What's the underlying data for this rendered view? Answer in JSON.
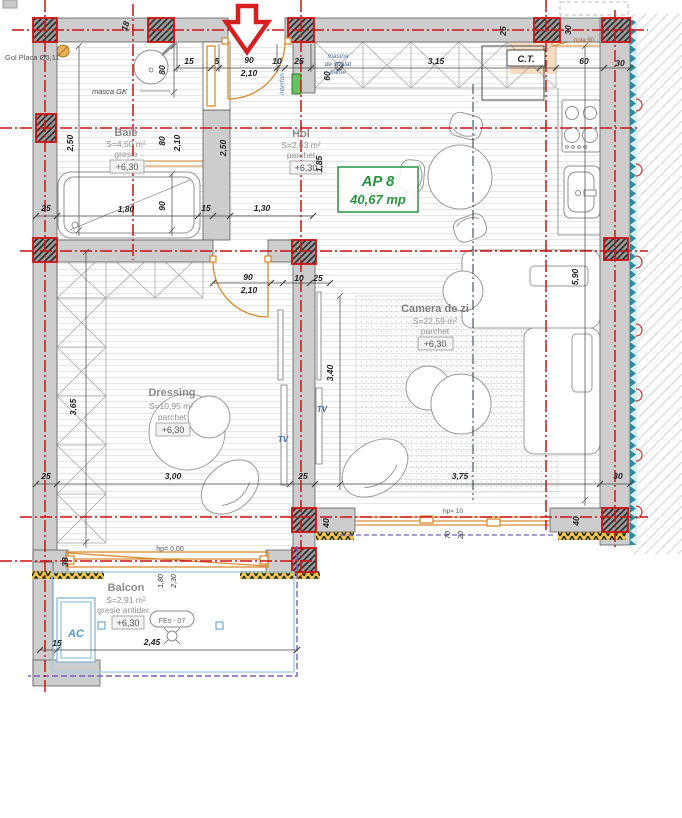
{
  "apartment": {
    "id": "AP 8",
    "area": "40,67 mp"
  },
  "rooms": {
    "baie": {
      "name": "Baie",
      "area": "S=4,50 m²",
      "finish": "gresie",
      "level": "+6,30"
    },
    "hol": {
      "name": "Hol",
      "area": "S=2,63 m²",
      "finish": "parchet",
      "level": "+6,30"
    },
    "camera_de_zi": {
      "name": "Camera de zi",
      "area": "S=22,59 m²",
      "finish": "parchet",
      "level": "+6,30"
    },
    "dressing": {
      "name": "Dressing",
      "area": "S=10,95 m²",
      "finish": "parchet",
      "level": "+6,30"
    },
    "balcon": {
      "name": "Balcon",
      "area": "S=2,91 m²",
      "finish": "gresie antider.",
      "level": "+6,30"
    }
  },
  "equipment": {
    "ct": "C.T.",
    "ac": "AC",
    "tv_left": "TV",
    "tv_right": "TV",
    "interfon": "interfon",
    "washing_machine": [
      "masina",
      "de spalat",
      "haine"
    ],
    "hood": "hota 90",
    "masca": "masca GK",
    "gol_placa": "Gol Placa Ø0,11",
    "window_code": "FEs - 07",
    "hp_balcony": "hp= 0,00",
    "hp_window": "hp= 10"
  },
  "dimensions": {
    "top_15": "15",
    "top_5": "5",
    "entry_door_width": "90",
    "entry_door_height": "2,10",
    "top_10": "10",
    "top_25": "25",
    "kitchen_wall": "3,15",
    "kitchen_60": "60",
    "kitchen_30": "30",
    "wall_25": "25",
    "hood_30": "30",
    "wall_18": "18",
    "washer_60": "60",
    "baie_height": "2,50",
    "sink_80": "80",
    "niche_80": "80",
    "niche_210": "2,10",
    "hol_height": "2,50",
    "hol_opening": "1,85",
    "tub_length": "1,80",
    "tub_width": "90",
    "left_25": "25",
    "wall_15": "15",
    "hol_width": "1,30",
    "dr_door_width": "90",
    "dr_door_height": "2,10",
    "dr_door_10": "10",
    "dr_door_25": "25",
    "living_340": "3,40",
    "living_590": "5,90",
    "living_375": "3,75",
    "right_30": "30",
    "col_40a": "40",
    "col_40b": "40",
    "dressing_365": "3,65",
    "dressing_300": "3,00",
    "bottom_25a": "25",
    "bottom_25b": "25",
    "balcony_38": "38",
    "balcony_15": "15",
    "balcony_245": "2,45",
    "balcony_window_180": "1,80",
    "balcony_window_230": "2,30",
    "sill_70": "70",
    "sill_20": "20"
  },
  "colors": {
    "axis_red": "#cc1111",
    "joinery_orange": "#d88a30",
    "apartment_green": "#27963f",
    "text_blue": "#3f6fae",
    "railing_purple": "#7a5fc0",
    "insulation_teal": "#2e8b9a"
  }
}
